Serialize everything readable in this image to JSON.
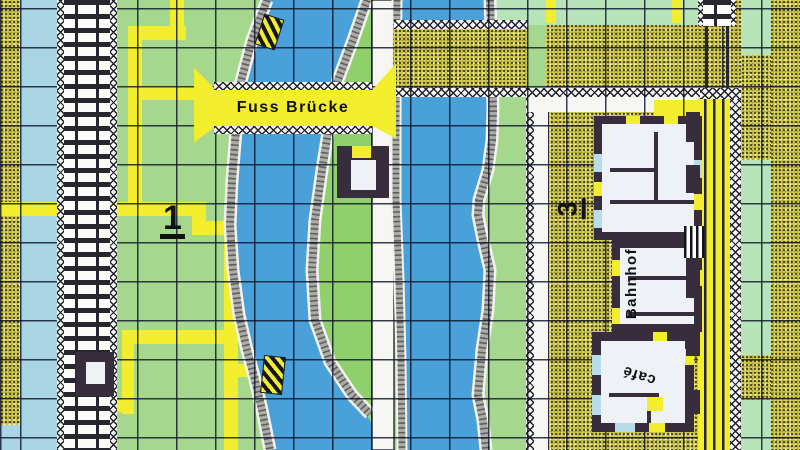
{
  "map": {
    "description": "Hand-drawn city game map with two canals, footbridge, railway lines and a train station",
    "labels": {
      "footbridge": "Fuss Brücke",
      "marker_1": "1",
      "marker_3": "3",
      "station": "Bahnhof",
      "cafe": "café"
    },
    "colors": {
      "water": "#4aa0d8",
      "grass": "#a5d88c",
      "island_grass": "#8fd06c",
      "mint_green": "#b7e3b9",
      "pale_blue_street": "#a9d4e4",
      "path_yellow": "#f2ee2e",
      "stipple_block": "#d6cf52",
      "building_wall": "#372d3c",
      "building_floor": "#eef2f6",
      "window_blue": "#b9dcea",
      "quay_grey": "#ababa8",
      "grid_line": "#0d1228"
    }
  }
}
